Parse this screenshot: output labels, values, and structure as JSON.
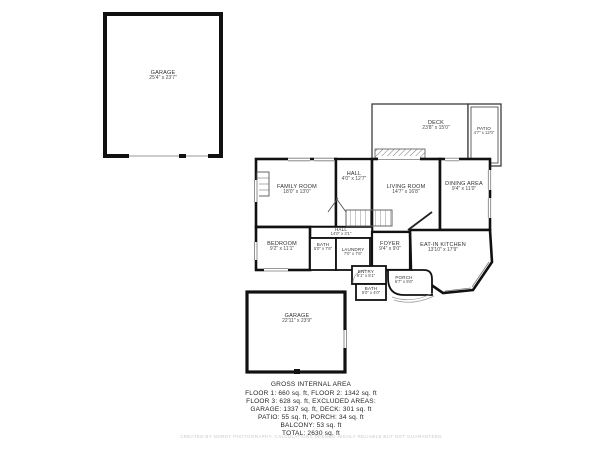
{
  "colors": {
    "wall": "#111111",
    "thin_line": "#8a8a8a",
    "text": "#2e2e2e",
    "disclaimer_text": "#c9c9c9",
    "background": "#ffffff"
  },
  "plan": {
    "rooms": {
      "garage_detached": {
        "name": "GARAGE",
        "dims": "25'4\" x 23'7\""
      },
      "deck": {
        "name": "DECK",
        "dims": "23'8\" x 15'0\""
      },
      "patio": {
        "name": "PATIO",
        "dims": "4'7\" x 12'0\""
      },
      "family_room": {
        "name": "FAMILY ROOM",
        "dims": "18'0\" x 13'0\""
      },
      "hall_upper": {
        "name": "HALL",
        "dims": "4'0\" x 12'7\""
      },
      "living_room": {
        "name": "LIVING ROOM",
        "dims": "14'7\" x 16'8\""
      },
      "dining_area": {
        "name": "DINING AREA",
        "dims": "9'4\" x 11'0\""
      },
      "hall_corridor": {
        "name": "HALL",
        "dims": "14'0\" x 3'1\""
      },
      "bedroom": {
        "name": "BEDROOM",
        "dims": "9'2\" x 11'1\""
      },
      "bath_main": {
        "name": "BATH",
        "dims": "5'0\" x 7'6\""
      },
      "laundry": {
        "name": "LAUNDRY",
        "dims": "7'0\" x 7'6\""
      },
      "foyer": {
        "name": "FOYER",
        "dims": "9'4\" x 9'0\""
      },
      "eat_in_kitchen": {
        "name": "EAT-IN KITCHEN",
        "dims": "13'10\" x 17'9\""
      },
      "entry": {
        "name": "ENTRY",
        "dims": "6'1\" x 5'1\""
      },
      "bath_small": {
        "name": "BATH",
        "dims": "5'0\" x 4'0\""
      },
      "porch": {
        "name": "PORCH",
        "dims": "6'7\" x 5'6\""
      },
      "garage_attached": {
        "name": "GARAGE",
        "dims": "22'11\" x 23'9\""
      }
    }
  },
  "summary": {
    "title": "GROSS INTERNAL AREA",
    "lines": [
      "FLOOR 1: 660 sq. ft, FLOOR 2: 1342 sq. ft",
      "FLOOR 3: 628 sq. ft, EXCLUDED AREAS:",
      "GARAGE: 1337 sq. ft, DECK: 301 sq. ft",
      "PATIO: 55 sq. ft, PORCH: 34 sq. ft",
      "BALCONY: 53 sq. ft",
      "TOTAL: 2630 sq. ft"
    ],
    "disclaimer": "CREATED BY NORDY PHOTOGRAPHY. CALCULATIONS DEEMED HIGHLY RELIABLE BUT NOT GUARANTEED"
  }
}
